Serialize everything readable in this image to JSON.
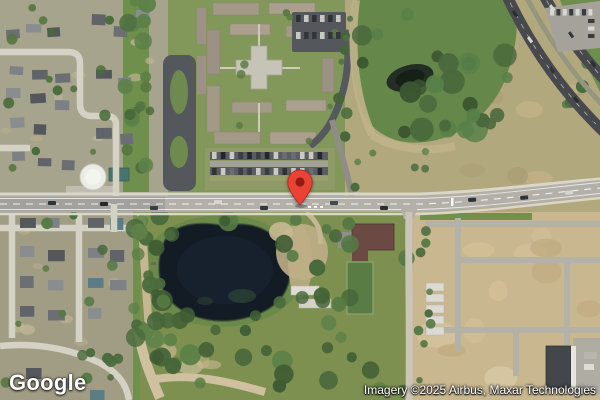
{
  "map": {
    "view_type": "satellite",
    "visible_features": [
      "residential-neighborhood-northwest",
      "residential-neighborhood-southwest",
      "apartment-complex-with-cross-building-north",
      "parking-lot-with-cars-center",
      "water-tank-facility-west",
      "dense-forest-with-small-pond-northeast",
      "divided-highway-northeast",
      "main-east-west-road",
      "dark-retention-pond-southwest",
      "rural-property-with-court-center-south",
      "construction-site-with-trailers-southeast"
    ]
  },
  "marker": {
    "label": "dropped-pin",
    "color": "#EA4335",
    "inner_color": "#8F1D14",
    "outline_color": "#B3251E"
  },
  "logo": {
    "text": "Google"
  },
  "attribution": {
    "text": "Imagery ©2025 Airbus, Maxar Technologies"
  }
}
